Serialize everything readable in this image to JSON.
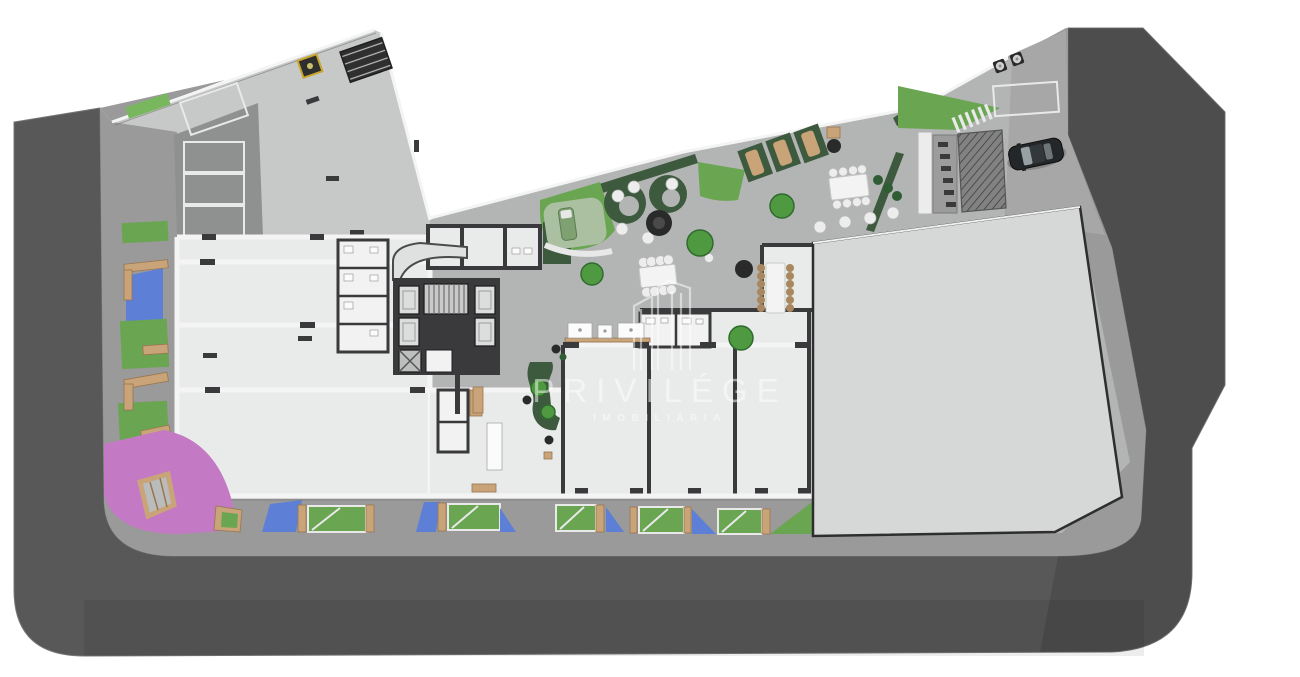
{
  "watermark": {
    "brand": "PRIVILÉGE",
    "tagline": "IMOBILIÁRIA",
    "logo_icon": "building-towers-outline-icon"
  },
  "scene": {
    "kind": "architectural ground-floor site plan, top-down 3D render",
    "areas": [
      "street",
      "sidewalk",
      "covered-parking",
      "central-plaza",
      "retail-units",
      "elevator-core",
      "large-hall-roof",
      "driveway-ramp",
      "playground",
      "lounge-garden"
    ],
    "covered_parking_stalls": 4,
    "permeable_parking_stalls": 6,
    "blue_painted_patches": 6,
    "accessible_stall_markers": 1,
    "cars": 1,
    "dining_tables": 3,
    "sun_loungers": 4,
    "trees": 6,
    "benches": 5
  },
  "icons": {
    "car": "car-icon",
    "tree": "tree-icon",
    "sun_lounger": "sun-lounger-icon",
    "accessible_marker": "accessible-parking-icon",
    "staircase": "staircase-icon",
    "elevator": "elevator-icon",
    "bench": "bench-icon",
    "grill": "grill-icon",
    "fire_table": "fire-table-icon",
    "bollard": "bollard-icon"
  },
  "colors": {
    "road": "#585858",
    "road-dark": "#474747",
    "sidewalk": "#9a9a9a",
    "driveway": "#a7a7a7",
    "plaza": "#b3b5b5",
    "garage-light": "#c7c9c9",
    "garage-dark": "#8f9191",
    "floor": "#e9eaea",
    "floor-bright": "#f2f2f2",
    "hall": "#d6d8d8",
    "wall-dark": "#3a3a3c",
    "wall-white": "#f4f4f4",
    "edge-shadow": "#777777",
    "lawn": "#6aa552",
    "lawn-bright": "#79b75e",
    "hedge": "#3e5a3e",
    "deck": "#abbfa1",
    "paint-blue": "#5e7fd6",
    "paint-pink": "#c379c3",
    "wood": "#c8a478",
    "wood-dark": "#9a7550",
    "tree": "#4f9a40",
    "tree-dark": "#2f6b2f",
    "bush": "#2e5d33",
    "stool": "#ededed",
    "table-white": "#f3f3f3",
    "chair-brown": "#a9875f",
    "dark-obj": "#2a2a2a",
    "car-body": "#24272a",
    "car-glass": "#97a0a3",
    "marker-yellow": "#c9a62e",
    "stripe-white": "#e9e9e9",
    "watermark": "#ffffff"
  }
}
